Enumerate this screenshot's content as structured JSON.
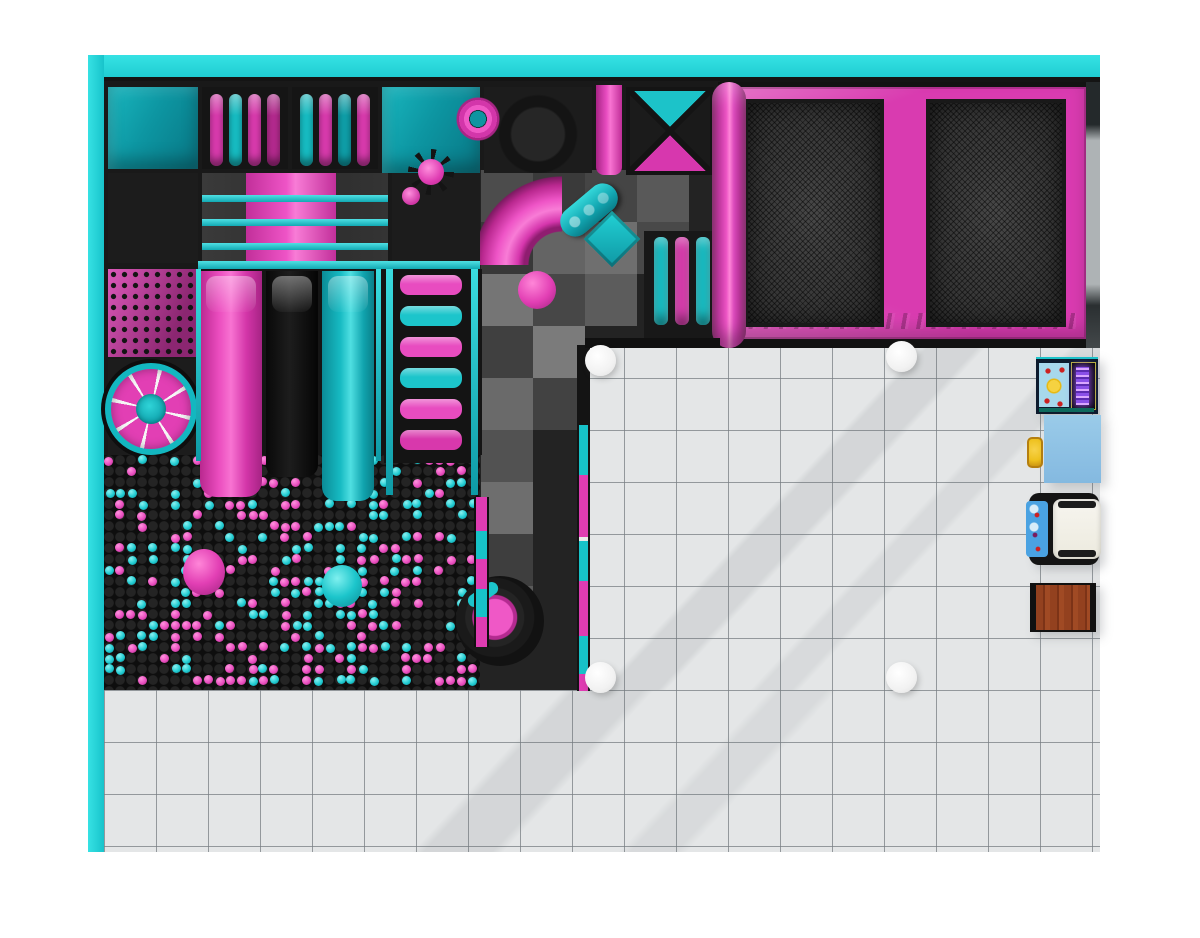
{
  "scene": {
    "type": "indoor-playground-floor-plan",
    "view": "top-down"
  },
  "palette": {
    "page_bg": "#ffffff",
    "wall_cyan": "#24d6da",
    "frame_black": "#161616",
    "pink": "#e23fb4",
    "pink_bright": "#f35ec9",
    "pink_dark": "#a82585",
    "cyan": "#18c2c8",
    "teal_panel": "#0e9aa6",
    "mesh_gray": "#3c3c3c",
    "checker_base": "#232323",
    "tile": "#e4e6e7",
    "tile_line": "#989da2",
    "column_white": "#f7f7f7",
    "wood": "#93411f",
    "table_blue": "#8ec4e8",
    "ride_blue": "#4aa2e2",
    "chair_yellow": "#eec11e",
    "screen_violet": "#a86cf0"
  },
  "structure": {
    "bar_cells": {
      "cell1": [
        "#df3cb2",
        "#17c2c8",
        "#df3cb2",
        "#b92b92"
      ],
      "cell2": [
        "#17c2c8",
        "#df3cb2",
        "#0fa3ad",
        "#df3cb2"
      ]
    },
    "ladder_rungs": [
      "#e84cc0",
      "#1cc5cb",
      "#e84cc0",
      "#1cc5cb",
      "#e84cc0",
      "#d838ac"
    ],
    "slide_stripes": [
      22,
      46,
      70
    ],
    "edge_segments": [
      [
        "#141414",
        80
      ],
      [
        "#17c2c8",
        50
      ],
      [
        "#df3cb2",
        62
      ],
      [
        "#e9e9e9",
        4
      ],
      [
        "#17c2c8",
        40
      ],
      [
        "#df3cb2",
        55
      ],
      [
        "#17c2c8",
        38
      ],
      [
        "#df3cb2",
        17
      ]
    ],
    "pit_edge_segments": [
      [
        "#df3cb2",
        34
      ],
      [
        "#17c2c8",
        28
      ],
      [
        "#df3cb2",
        30
      ],
      [
        "#17c2c8",
        28
      ],
      [
        "#df3cb2",
        30
      ]
    ],
    "checker_patches": [
      [
        377,
        89,
        "#4c4c4c"
      ],
      [
        429,
        89,
        "#3a3a3a"
      ],
      [
        481,
        89,
        "#454545"
      ],
      [
        533,
        89,
        "#595959"
      ],
      [
        377,
        141,
        "#383838"
      ],
      [
        429,
        141,
        "#646464"
      ],
      [
        481,
        141,
        "#6f6f6f"
      ],
      [
        533,
        141,
        "#494949"
      ],
      [
        377,
        193,
        "#757575"
      ],
      [
        429,
        193,
        "#474747"
      ],
      [
        481,
        193,
        "#5c5c5c"
      ],
      [
        377,
        245,
        "#404040"
      ],
      [
        429,
        245,
        "#7b7b7b"
      ],
      [
        377,
        297,
        "#6a6a6a"
      ],
      [
        429,
        297,
        "#424242"
      ],
      [
        377,
        349,
        "#525252"
      ],
      [
        377,
        401,
        "#6e6e6e"
      ],
      [
        377,
        453,
        "#3e3e3e"
      ],
      [
        377,
        505,
        "#5a5a5a"
      ]
    ],
    "bottom_ticks": [
      [
        28,
        56
      ],
      [
        104,
        80
      ],
      [
        261,
        107
      ]
    ]
  },
  "ball_pit": {
    "seed": 7,
    "grid": 11,
    "cols": 34,
    "rows": 21,
    "fill": 0.44,
    "colors": [
      "#ea4fc0",
      "#21ccd2"
    ],
    "highlights": [
      "#ff93de",
      "#8bf1f1"
    ],
    "shadows": [
      "#a2287f",
      "#0c8791"
    ]
  },
  "trampoline": {
    "bed_count": 2,
    "pad_color": "#d93bb0",
    "bed_color": "#3c3c3c"
  },
  "columns": [
    [
      601,
      361
    ],
    [
      902,
      357
    ],
    [
      601,
      678
    ],
    [
      902,
      678
    ]
  ],
  "furniture": [
    "arcade-machine",
    "kids-chair",
    "kids-table-blue",
    "ride-machine",
    "wooden-table"
  ]
}
